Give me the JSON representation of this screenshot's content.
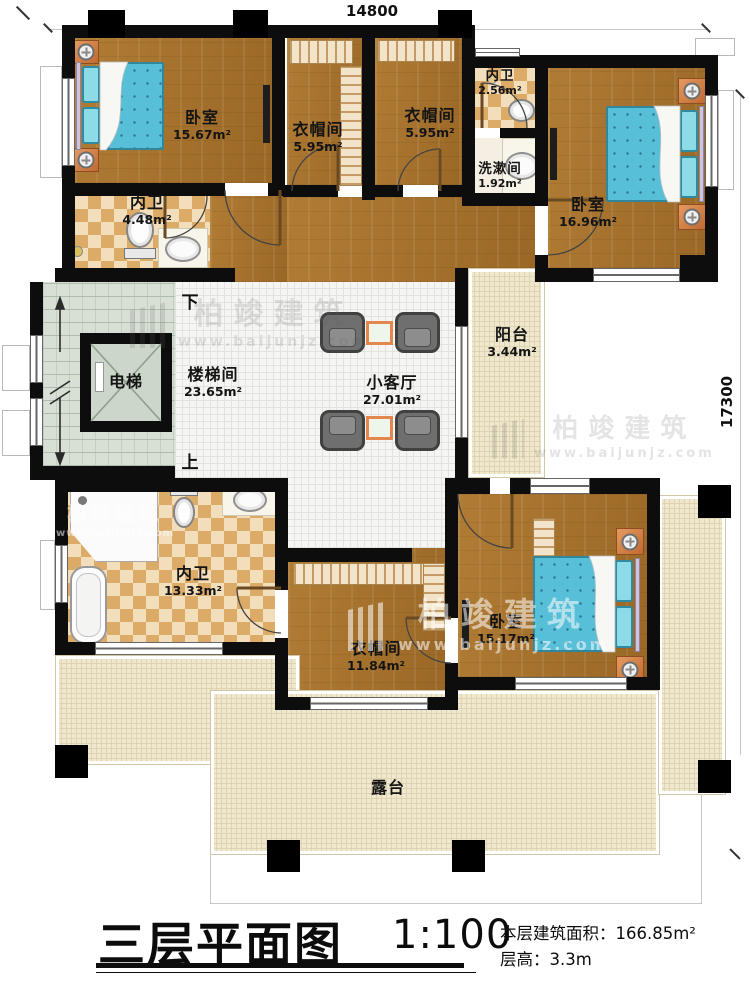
{
  "dimensions": {
    "width": "14800",
    "height": "17300"
  },
  "rooms": {
    "bedroom_tl": {
      "name": "卧室",
      "area": "15.67m²"
    },
    "closet_tl": {
      "name": "衣帽间",
      "area": "5.95m²"
    },
    "closet_tm": {
      "name": "衣帽间",
      "area": "5.95m²"
    },
    "bath_tm": {
      "name": "内卫",
      "area": "2.56m²"
    },
    "washroom": {
      "name": "洗漱间",
      "area": "1.92m²"
    },
    "bedroom_tr": {
      "name": "卧室",
      "area": "16.96m²"
    },
    "bath_tl": {
      "name": "内卫",
      "area": "4.48m²"
    },
    "elevator": {
      "name": "电梯"
    },
    "stairwell": {
      "name": "楼梯间",
      "area": "23.65m²"
    },
    "living": {
      "name": "小客厅",
      "area": "27.01m²"
    },
    "balcony": {
      "name": "阳台",
      "area": "3.44m²"
    },
    "bath_bl": {
      "name": "内卫",
      "area": "13.33m²"
    },
    "closet_b": {
      "name": "衣帽间",
      "area": "11.84m²"
    },
    "bedroom_br": {
      "name": "卧室",
      "area": "15.17m²"
    },
    "terrace": {
      "name": "露台"
    }
  },
  "stairs": {
    "down": "下",
    "up": "上"
  },
  "titleblock": {
    "title": "三层平面图",
    "scale": "1:100",
    "area_label": "本层建筑面积：",
    "area_value": "166.85m²",
    "floor_height_label": "层高：",
    "floor_height_value": "3.3m"
  },
  "watermark": {
    "brand": "柏竣建筑",
    "url": "www.baijunjz.com"
  },
  "colors": {
    "wood": "#a9762f",
    "tile": "#dcab67",
    "terrace": "#efe8cf",
    "stair": "#d8e0d5",
    "bed": "#58bfd8",
    "wall": "#0d0d0d"
  }
}
